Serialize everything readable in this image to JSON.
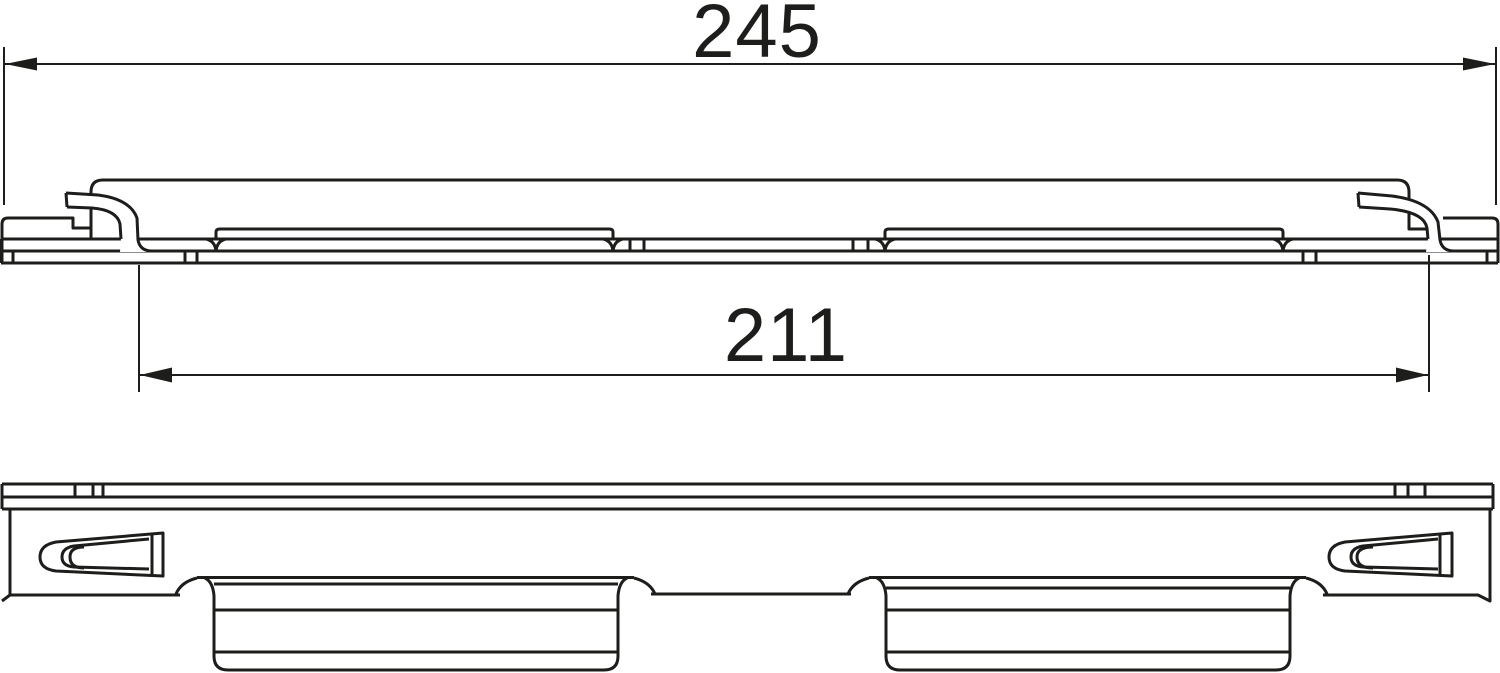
{
  "drawing": {
    "background_color": "#ffffff",
    "line_color": "#1d1d1b",
    "dimensions": {
      "overall_length": {
        "value": "245"
      },
      "clip_span": {
        "value": "211"
      }
    }
  }
}
